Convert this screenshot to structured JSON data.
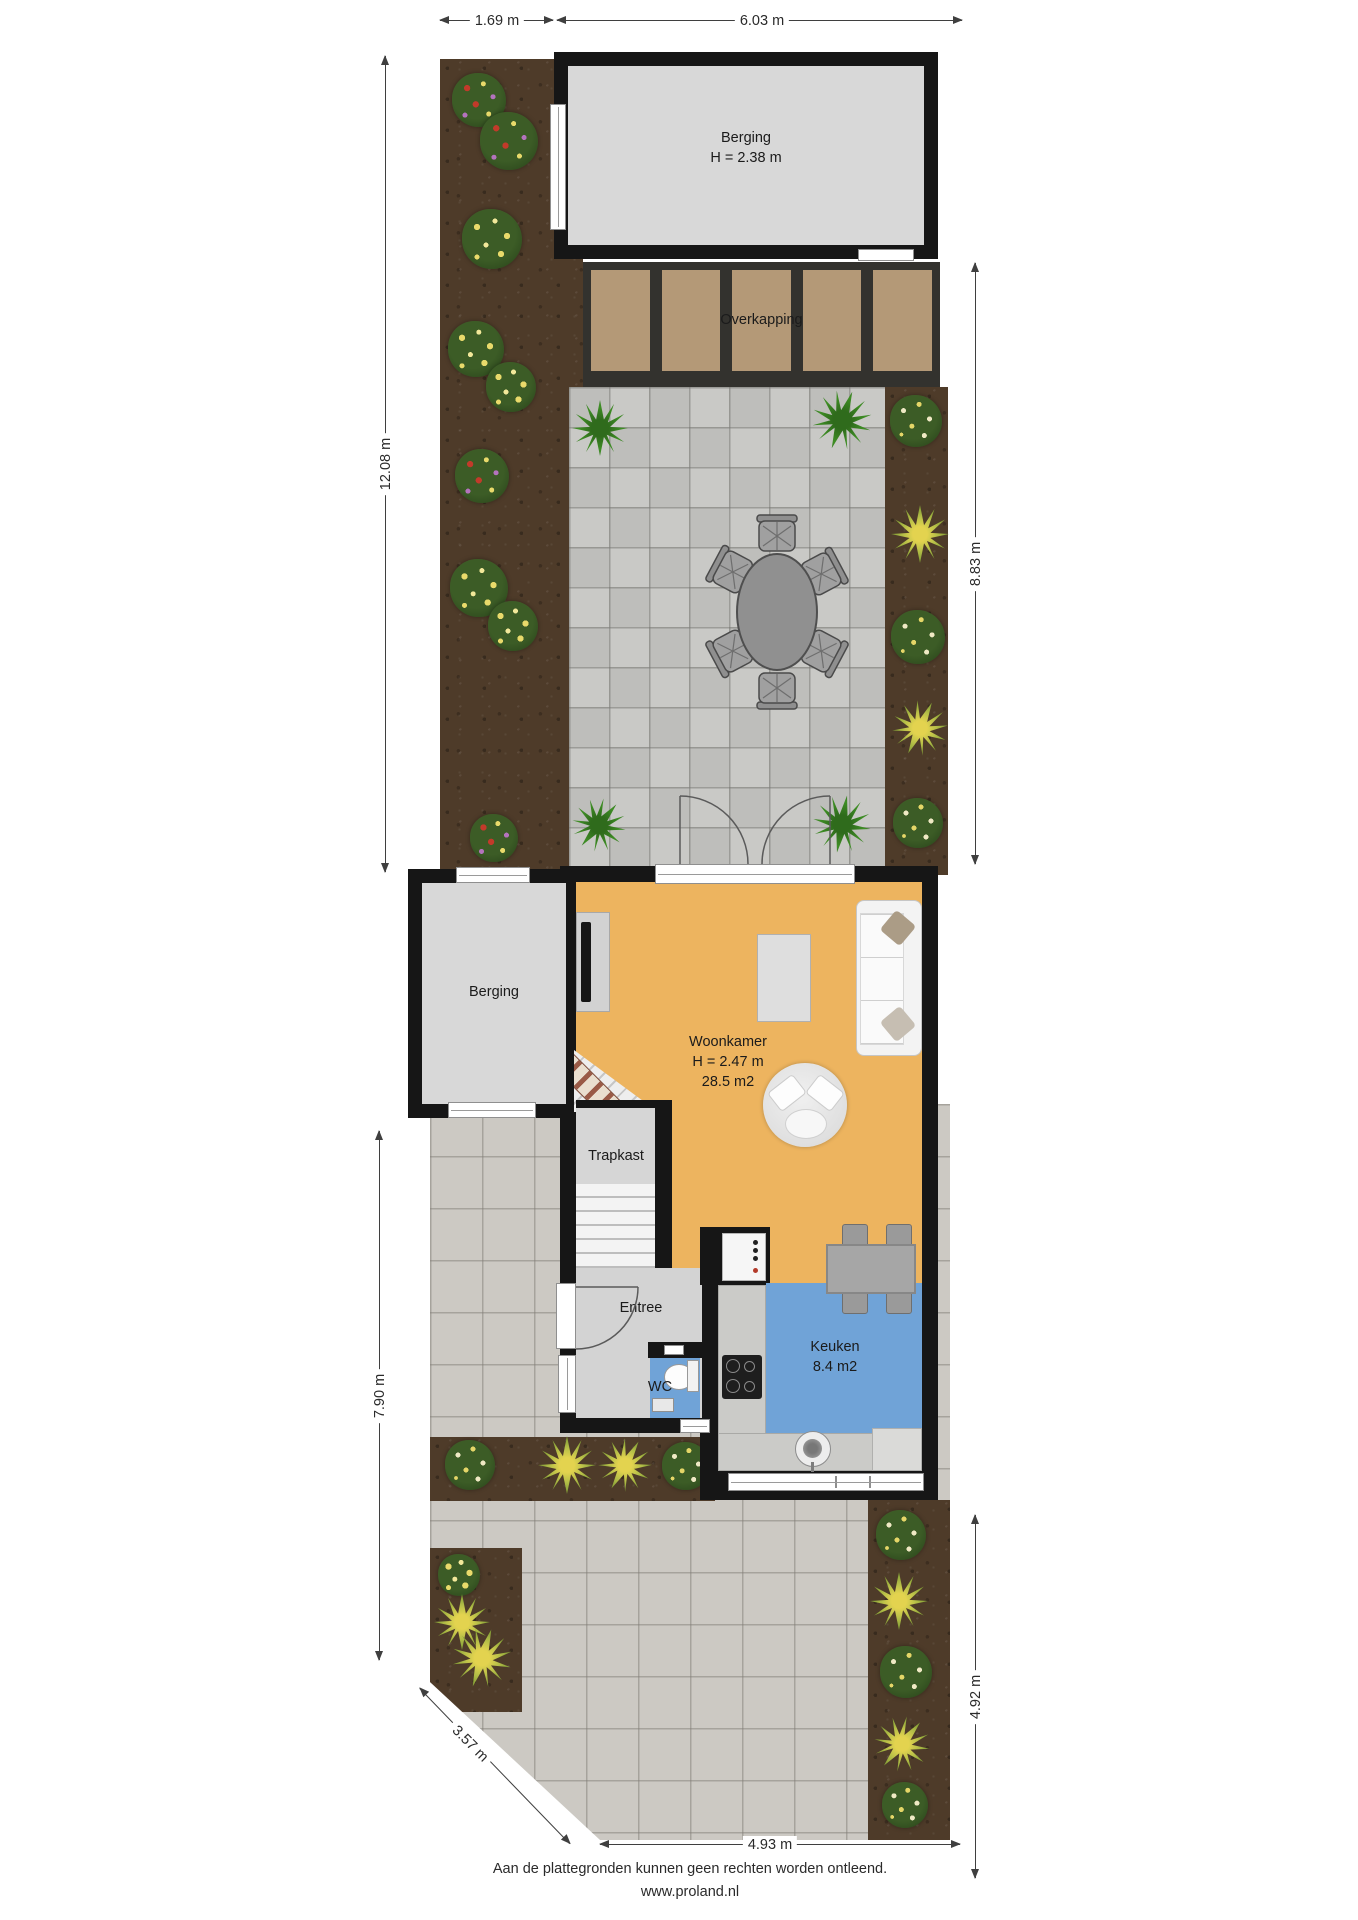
{
  "annotations": {
    "dim_top_left": "1.69 m",
    "dim_top_right": "6.03 m",
    "dim_left_upper": "12.08 m",
    "dim_left_lower": "7.90 m",
    "dim_right_upper": "8.83 m",
    "dim_right_lower": "4.92 m",
    "dim_bottom": "4.93 m",
    "dim_diagonal": "3.57 m"
  },
  "rooms": {
    "berging_top": {
      "name": "Berging",
      "height": "H = 2.38 m"
    },
    "overkapping": {
      "name": "Overkapping"
    },
    "berging_left": {
      "name": "Berging"
    },
    "woonkamer": {
      "name": "Woonkamer",
      "height": "H = 2.47 m",
      "area": "28.5 m2"
    },
    "trapkast": {
      "name": "Trapkast"
    },
    "entree": {
      "name": "Entree"
    },
    "wc": {
      "name": "WC"
    },
    "keuken": {
      "name": "Keuken",
      "area": "8.4 m2"
    }
  },
  "footer": {
    "disclaimer": "Aan de plattegronden kunnen geen rechten worden ontleend.",
    "website": "www.proland.nl"
  },
  "colors": {
    "wall": "#161616",
    "living_floor": "#edb45f",
    "kitchen_floor": "#70a3d7",
    "storage_floor": "#d8d8d8",
    "entry_floor": "#d3d3d3",
    "soil": "#4e3b29",
    "paving_small": "#c6c6c3",
    "paving_large": "#ccc9c3",
    "canopy_panel": "#b49977",
    "canopy_frame": "#33322e"
  }
}
